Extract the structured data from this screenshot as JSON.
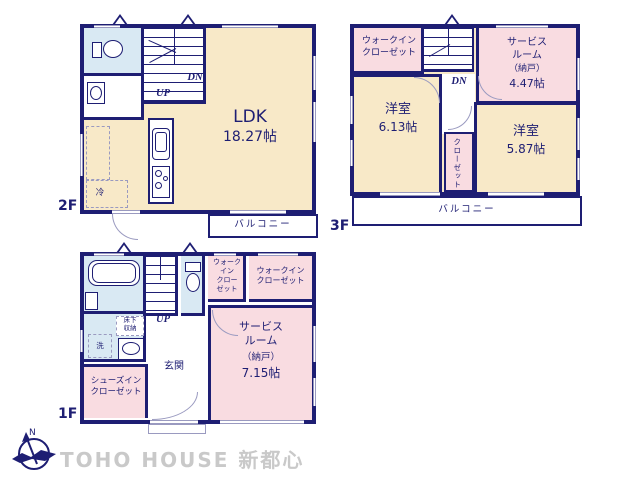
{
  "watermark": "TOHO HOUSE 新都心",
  "compass": {
    "north": "N"
  },
  "colors": {
    "wall": "#1e1e73",
    "room_cream": "#f8e9c8",
    "room_pink": "#f9dce1",
    "room_blue": "#d9e9f3",
    "watermark_gray": "#c9c9c9"
  },
  "floor2": {
    "label": "2F",
    "ldk_name": "LDK",
    "ldk_size": "18.27帖",
    "balcony": "バルコニー",
    "up": "UP",
    "dn": "DN",
    "fridge": "冷"
  },
  "floor3": {
    "label": "3F",
    "wic": "ウォークイン\nクローゼット",
    "service_name": "サービス\nルーム",
    "service_note": "（納戸）",
    "service_size": "4.47帖",
    "bedroom1_name": "洋室",
    "bedroom1_size": "6.13帖",
    "bedroom2_name": "洋室",
    "bedroom2_size": "5.87帖",
    "closet": "クローゼット",
    "balcony": "バルコニー",
    "dn": "DN"
  },
  "floor1": {
    "label": "1F",
    "wic_small": "ウォーク\nイン\nクロー\nゼット",
    "wic_large": "ウォークイン\nクローゼット",
    "service_name": "サービス\nルーム",
    "service_note": "（納戸）",
    "service_size": "7.15帖",
    "entrance": "玄関",
    "shoes_closet": "シューズイン\nクローゼット",
    "underfloor_storage": "床下\n収納",
    "washer": "洗",
    "up": "UP"
  }
}
